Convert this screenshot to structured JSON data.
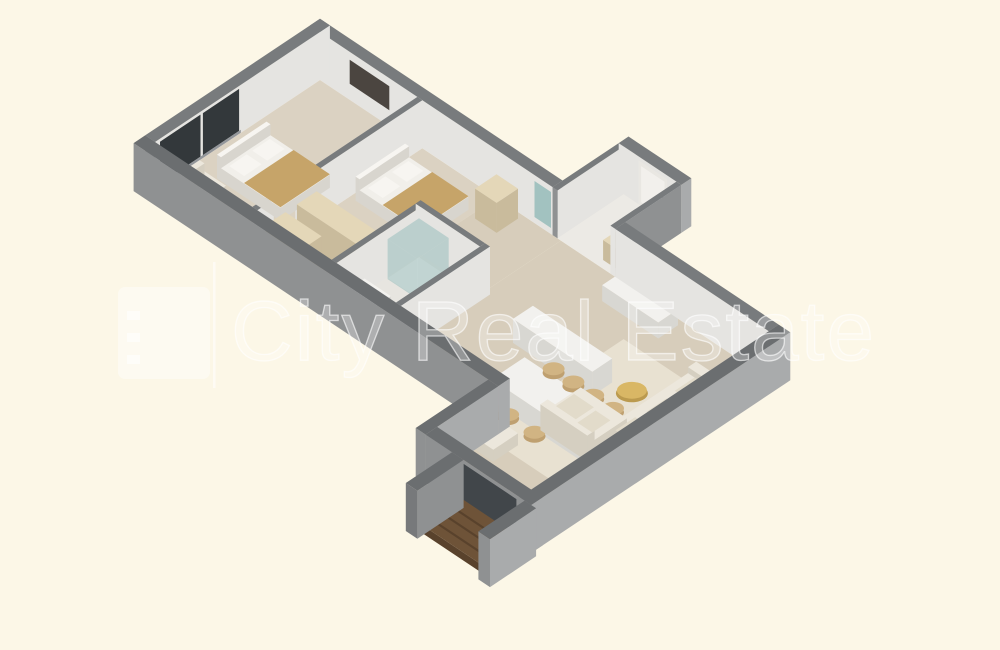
{
  "title": "3D isometric apartment floor plan render",
  "background_color": "#fcf7e7",
  "watermark": {
    "logo": "city-real-estate-logo",
    "divider": "|",
    "text": "City Real Estate",
    "color": "#ffffff"
  },
  "floor_plan": {
    "style": "isometric-3d-cutaway-render",
    "rooms": [
      {
        "name": "bedroom-1",
        "furniture": [
          "double-bed",
          "headboard",
          "pillows",
          "tan-blanket",
          "armchair",
          "tv-panel",
          "floor-to-ceiling-windows"
        ]
      },
      {
        "name": "bedroom-2",
        "furniture": [
          "double-bed",
          "wardrobe-cabinets"
        ]
      },
      {
        "name": "bathroom",
        "furniture": [
          "glass-shower",
          "vanity-sink",
          "toilet"
        ]
      },
      {
        "name": "hallway",
        "furniture": [
          "cabinet",
          "kitchen-island",
          "sideboard"
        ]
      },
      {
        "name": "entry",
        "furniture": [
          "front-door",
          "wall-mirror",
          "storage-bench"
        ]
      },
      {
        "name": "living-dining",
        "furniture": [
          "kitchen-counter",
          "dining-table",
          "dining-chairs",
          "corner-sofa",
          "cushions",
          "coffee-table",
          "armchair",
          "rug",
          "balcony-glazing"
        ]
      },
      {
        "name": "balcony",
        "furniture": [
          "wood-deck"
        ]
      }
    ],
    "palette": {
      "wallTop": "#787b7d",
      "wallTopDark": "#6b6e70",
      "wallFaceWhite": "#e5e4e1",
      "wallFaceLight": "#a9abac",
      "wallFaceMid": "#8f9192",
      "wallFaceDarker": "#77797b",
      "floorWood": "#d7cdbb",
      "floorBed": "#dbd2c2",
      "floorBath": "#e7e5e0",
      "floorTile": "#eceae5",
      "rug": "#e8e1d1",
      "tv": "#4b4540",
      "teal": "#a2c2c0",
      "windowGlass": "#33383b",
      "windowFrame": "#93969a",
      "door": "#e9e7e2",
      "doorPanel": "#f2f0ec",
      "glazing": "#41464a",
      "woodFurn": "#e4d7b8",
      "woodSide": "#c9bb9c",
      "bedBase": "#f1efea",
      "bedSide": "#d8d5ce",
      "blanket": "#c6a469",
      "pillow": "#f7f5f1",
      "fixture": "#f3f2ef",
      "fixtureSide": "#dbd9d4",
      "white": "#ffffff",
      "counter": "#f2f1ee",
      "counterSide": "#d8d7d2",
      "sofa": "#ece7dc",
      "sofaSide": "#d5cfc1",
      "cushion": "#e2dbca",
      "chair": "#d1b483",
      "chairDark": "#bfa070",
      "coffee": "#d9b765",
      "coffeeSide": "#bb9a4e",
      "deck": "#6e5338",
      "deckDark": "#59422c"
    }
  }
}
